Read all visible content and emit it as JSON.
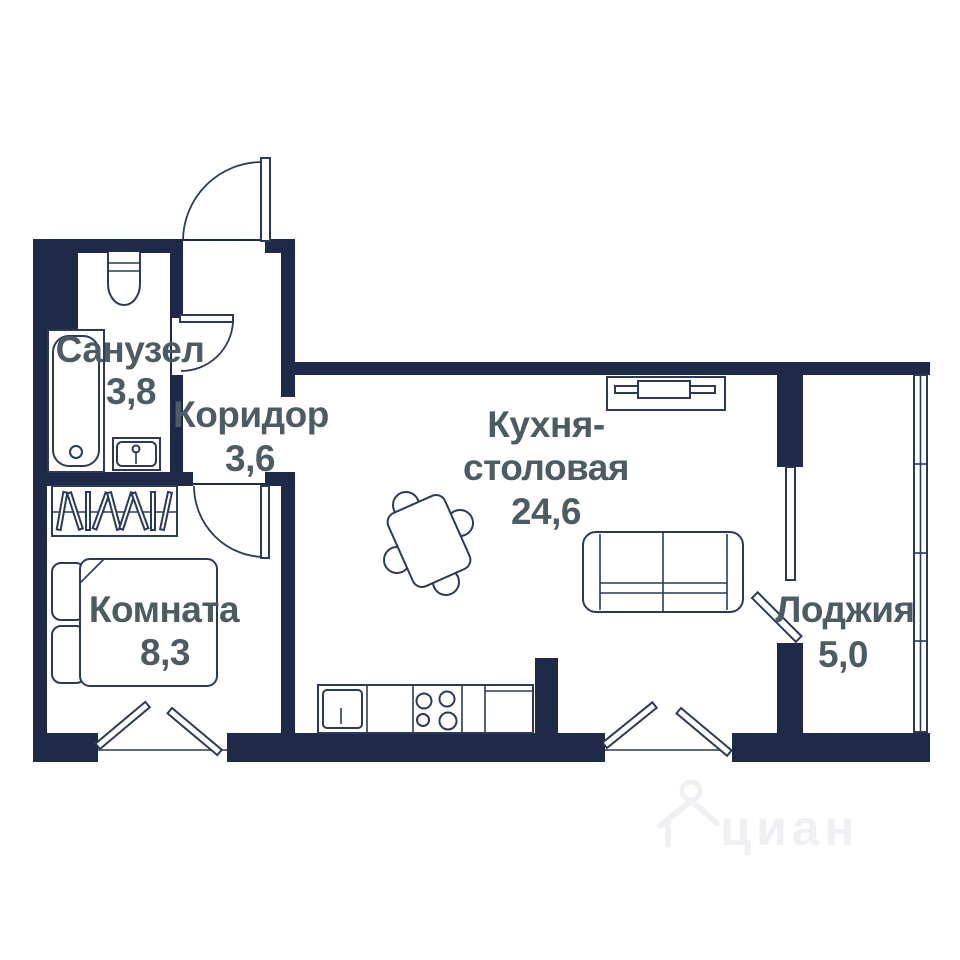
{
  "plan": {
    "rooms": [
      {
        "id": "bathroom",
        "name": "Санузел",
        "area": "3,8"
      },
      {
        "id": "corridor",
        "name": "Коридор",
        "area": "3,6"
      },
      {
        "id": "kitchen_dining",
        "name": "Кухня-столовая",
        "name_line1": "Кухня-",
        "name_line2": "столовая",
        "area": "24,6"
      },
      {
        "id": "room",
        "name": "Комната",
        "area": "8,3"
      },
      {
        "id": "loggia",
        "name": "Лоджия",
        "area": "5,0"
      }
    ],
    "watermark": {
      "text": "циан"
    },
    "colors": {
      "wall": "#1e2a48",
      "furniture_line": "#2c3a57",
      "label_text": "#4d5c63",
      "background": "#ffffff",
      "watermark": "#eef0f3"
    }
  }
}
